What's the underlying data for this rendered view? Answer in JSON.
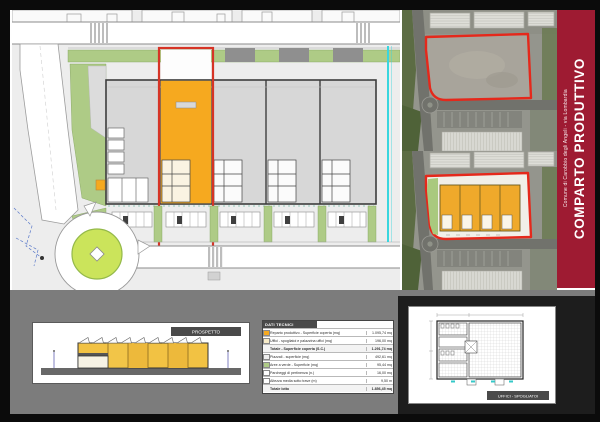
{
  "banner": {
    "title": "COMPARTO PRODUTTIVO",
    "subtitle": "Comune di Carobbio degli Angeli - via Lombardia",
    "color": "#9e1b32"
  },
  "elevation": {
    "label": "PROSPETTO"
  },
  "floorplan": {
    "label": "UFFICI - SPOGLIATOI"
  },
  "table": {
    "header": "DATI TECNICI",
    "rows": [
      {
        "swatch": "#F6A91F",
        "label": "Reparto produttivo - Superficie coperta (mq)",
        "value": "1.095,74 mq"
      },
      {
        "swatch": "#F7EBC8",
        "label": "Uffici - spogliatoi e palazzina uffici (mq)",
        "value": "196,00 mq"
      },
      {
        "swatch": null,
        "label": "Totale - Superficie coperta (S.C.)",
        "value": "1.291,74 mq"
      },
      {
        "swatch": "#EDEDED",
        "label": "Piazzali - superficie (mq)",
        "value": "492,61 mq"
      },
      {
        "swatch": "#AECB86",
        "label": "Aree a verde - Superficie (mq)",
        "value": "95,44 mq"
      },
      {
        "swatch": "#FFFFFF",
        "label": "Parcheggi di pertinenza (n.)",
        "value": "16,00 mq"
      },
      {
        "swatch": "#FFFFFF",
        "label": "Altezza media sotto trave (m)",
        "value": "9,50 m"
      },
      {
        "swatch": null,
        "label": "Totale lotto",
        "value": "1.856,45 mq"
      }
    ]
  },
  "colors": {
    "highlight_orange": "#F6A91F",
    "outline_red": "#D63426",
    "banner_red": "#9E1B32",
    "site_green": "#AECB86",
    "stream_cyan": "#39D6DE"
  }
}
